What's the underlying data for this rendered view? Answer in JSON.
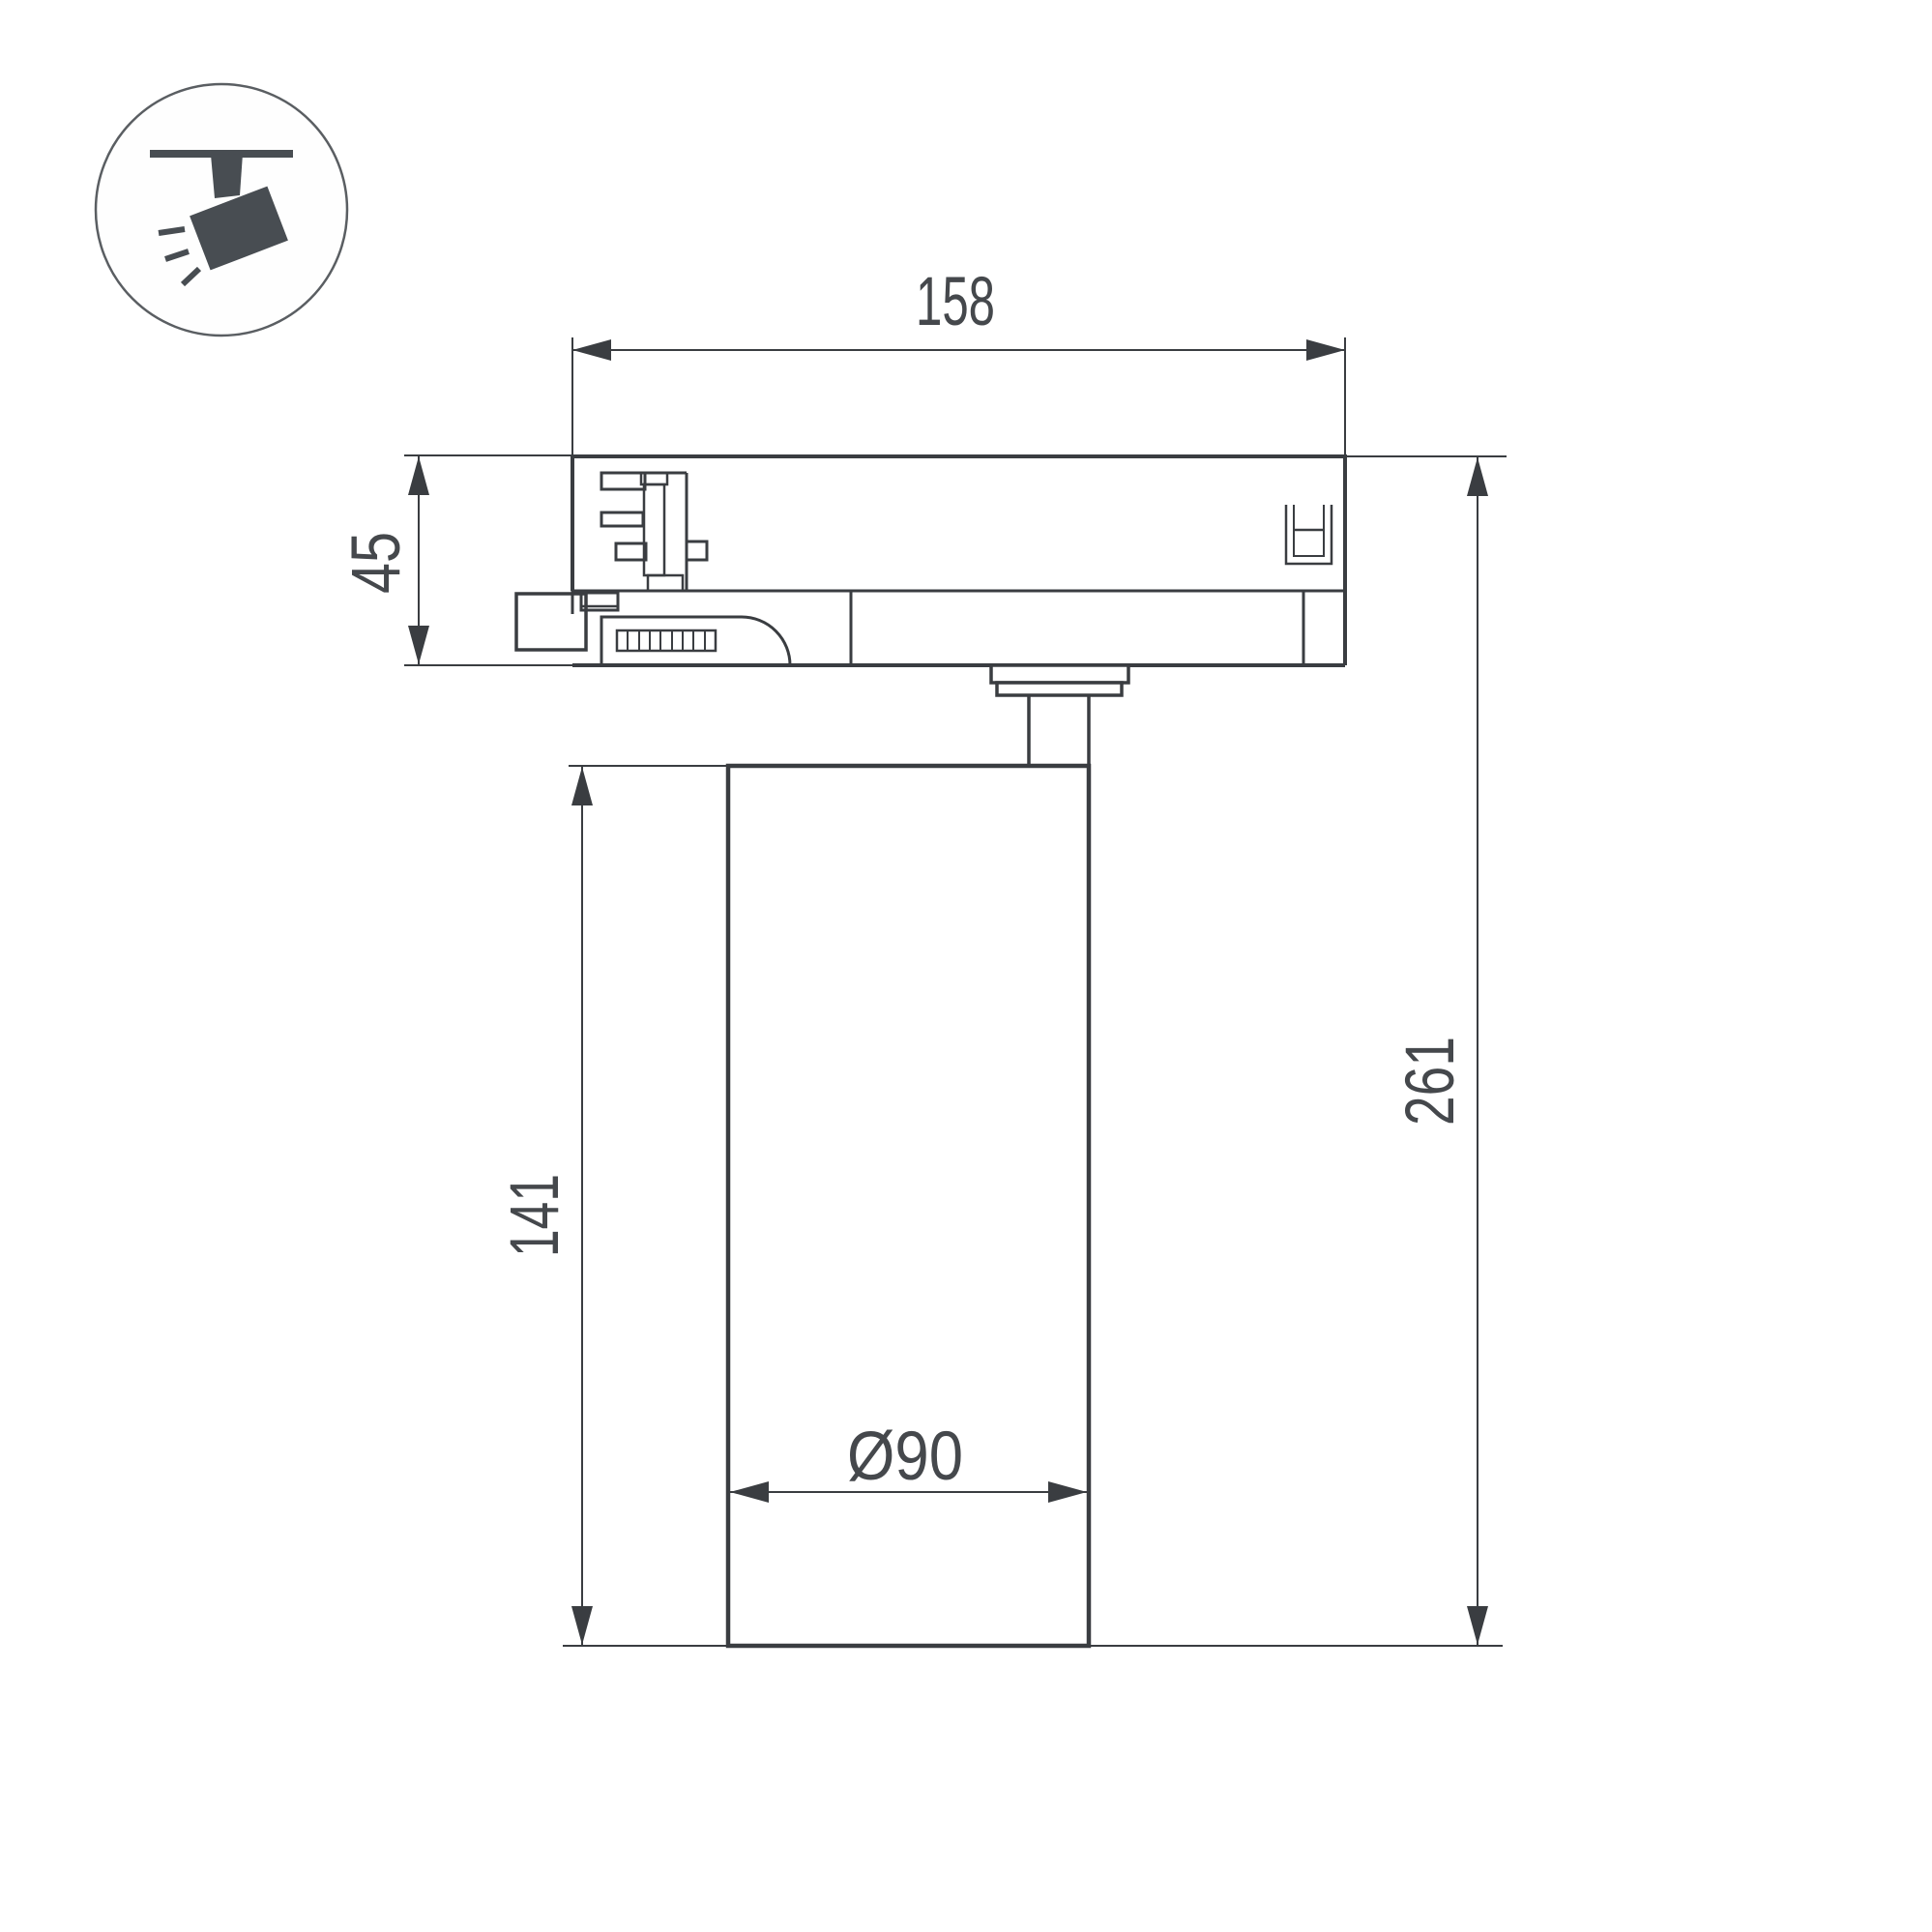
{
  "colors": {
    "background": "#ffffff",
    "line": "#3a3d41",
    "text": "#45484c",
    "icon_fill": "#484d52",
    "icon_ring": "#5a5e62"
  },
  "icon": {
    "name": "ceiling-track-spotlight"
  },
  "dimensions": {
    "track_adapter_length": {
      "value": "158"
    },
    "track_adapter_height": {
      "value": "45"
    },
    "lamp_body_height": {
      "value": "141"
    },
    "total_height": {
      "value": "261"
    },
    "lamp_body_diameter": {
      "value": "Ø90"
    }
  }
}
